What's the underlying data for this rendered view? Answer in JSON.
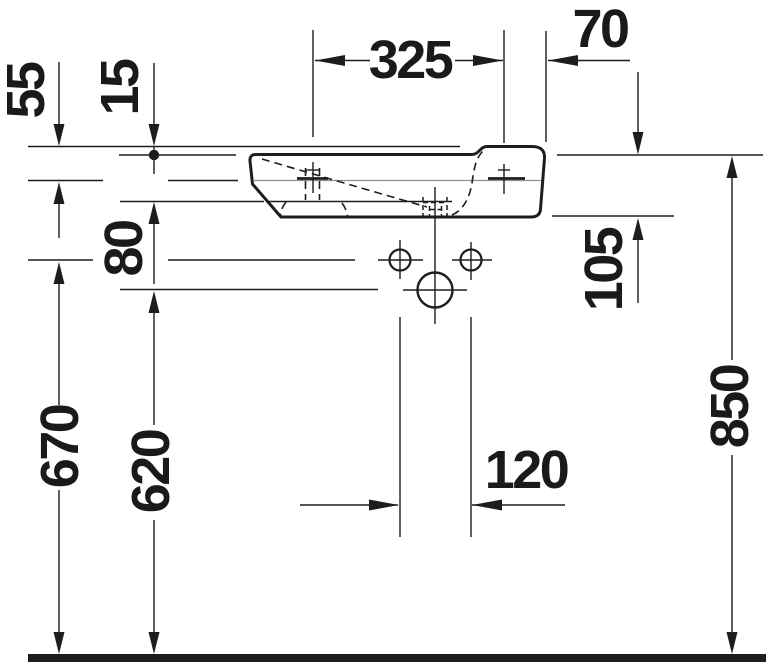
{
  "meta": {
    "background_color": "#ffffff",
    "line_color": "#1d1d1b",
    "label_color": "#1a1a1a"
  },
  "dims": {
    "d55": "55",
    "d15": "15",
    "d325": "325",
    "d70": "70",
    "d80": "80",
    "d105": "105",
    "d670": "670",
    "d620": "620",
    "d120": "120",
    "d850": "850"
  }
}
